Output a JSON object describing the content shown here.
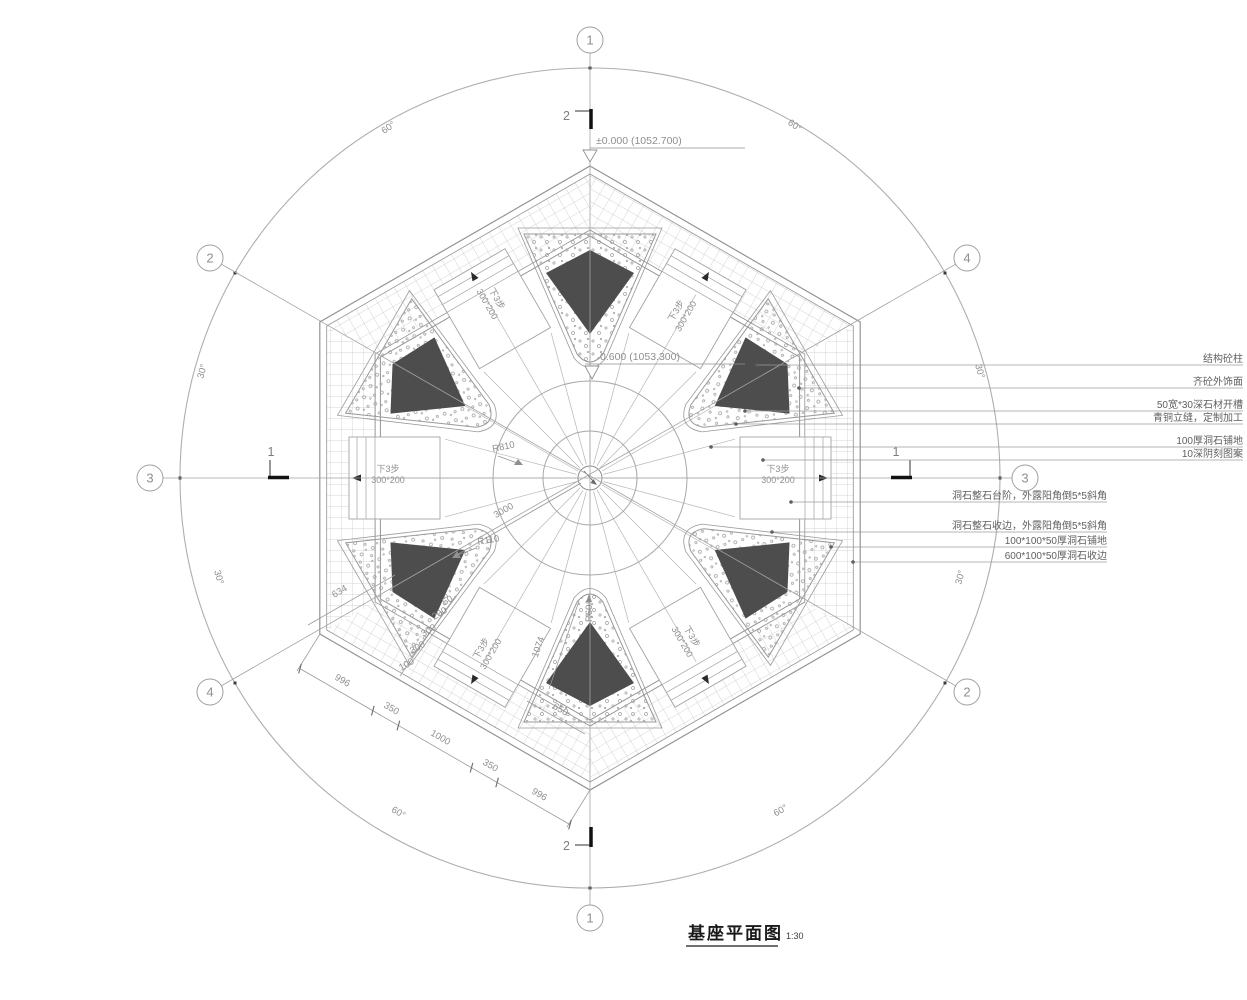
{
  "drawing": {
    "title": "基座平面图",
    "scale": "1:30"
  },
  "elevations": {
    "outer": "±0.000 (1052.700)",
    "inner": "0.600 (1053.300)"
  },
  "axis_bubbles": {
    "top": "1",
    "bottom": "1",
    "left": "3",
    "right": "3",
    "top_left": "2",
    "top_right": "4",
    "bottom_left": "4",
    "bottom_right": "2"
  },
  "section_marks": {
    "top": "2",
    "bottom": "2",
    "left": "1",
    "right": "1"
  },
  "angle_labels": {
    "top_left": "60°",
    "top_right": "60°",
    "upper_left": "30°",
    "upper_right": "30°",
    "lower_left": "30°",
    "lower_right": "30°",
    "bottom_left": "60°",
    "bottom_right": "60°"
  },
  "radius_labels": {
    "r810": "R810",
    "r110": "R110",
    "r60": "R60"
  },
  "step_label": {
    "line1": "下3步",
    "line2": "300*200"
  },
  "dimensions": {
    "edge_segments": [
      "996",
      "350",
      "1000",
      "350",
      "996"
    ],
    "diagonal": "3000",
    "side": "1074",
    "corner": "634",
    "bottom": "650",
    "step_risers": [
      "100",
      "300",
      "300",
      "200",
      "50"
    ]
  },
  "annotations": {
    "upper": [
      "结构砼柱",
      "齐砼外饰面",
      "50宽*30深石材开槽",
      "青铜立缝，定制加工",
      "100厚洞石铺地",
      "10深阴刻图案"
    ],
    "lower": [
      "洞石整石台阶，外露阳角倒5*5斜角",
      "洞石整石收边，外露阳角倒5*5斜角",
      "100*100*50厚洞石铺地",
      "600*100*50厚洞石收边"
    ]
  }
}
